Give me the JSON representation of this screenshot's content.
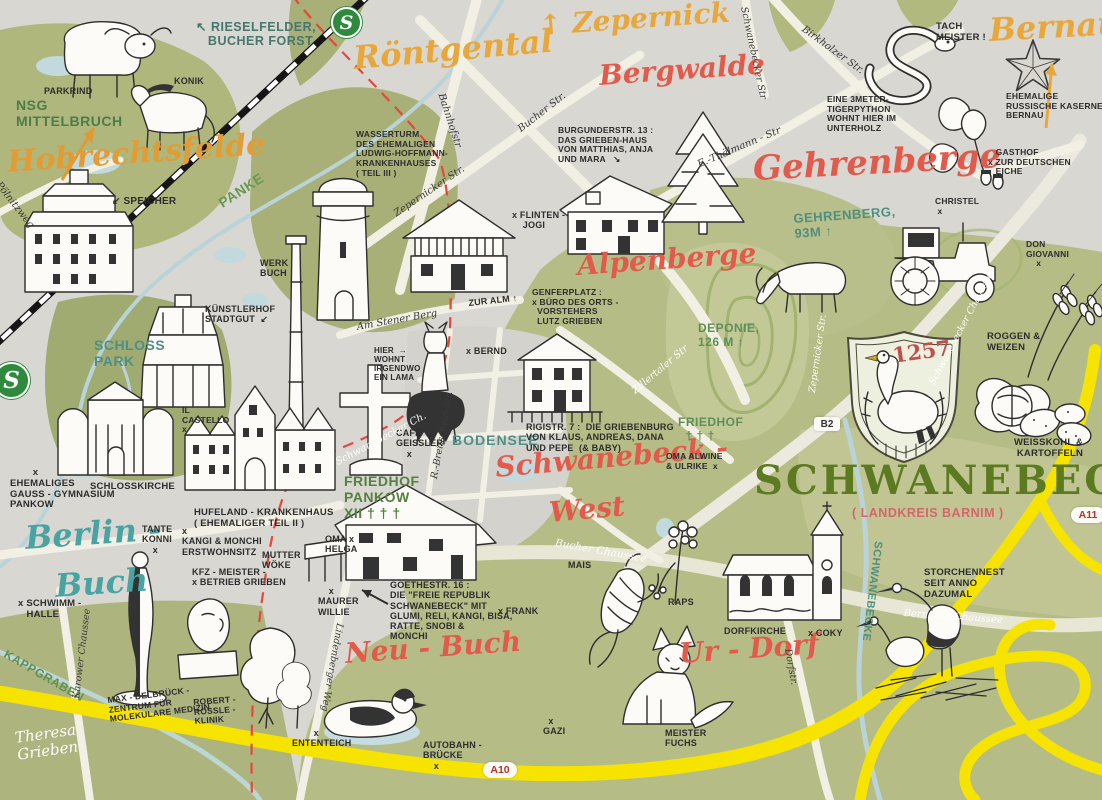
{
  "meta": {
    "map_subject": "Schwanebeck illustrated map"
  },
  "badges": {
    "sbahn_top": "S",
    "sbahn_left": "S",
    "b2": "B2",
    "a10": "A10",
    "a11": "A11"
  },
  "colors": {
    "paper": "#d8d7d2",
    "green_dark": "#9fab70",
    "green_mid": "#b5bc86",
    "green_light": "#c6ca9b",
    "road": "#f2efe4",
    "autobahn_yellow": "#f6e400",
    "water": "#b9d3d9",
    "railway": "#151515",
    "border_red": "#e2493c",
    "script_orange": "#e8a73a",
    "script_red": "#e25a4b",
    "script_teal": "#49a3a3",
    "label_green": "#55803f",
    "title_green": "#5c7a20",
    "crest_year_red": "#c0504d"
  },
  "illustrations": [
    "parkrind-cow",
    "konik-pony",
    "speicher-building",
    "water-tower",
    "chimney",
    "kuenstlerhof-rotunda",
    "schlosskirche-building",
    "hufeland-krankenhaus-building",
    "cemetery-cross",
    "alm-house",
    "grieben-haus",
    "fir-tree",
    "llama",
    "griebenburg-house",
    "goethestrasse-house",
    "woman-statue",
    "bust-statue",
    "birch-trees",
    "duck",
    "corn-cob",
    "raps-flower",
    "dorfkirche-church",
    "fox",
    "stork-nest",
    "tractor",
    "deer",
    "snake",
    "soviet-star",
    "oak-branch",
    "swan-crest",
    "wheat",
    "cabbage",
    "potatoes"
  ],
  "labels": [
    {
      "id": "place-hobrechtsfelde",
      "t": "Hobrechtsfelde",
      "x": 6,
      "y": 146,
      "s": 30,
      "c": "#e29c33",
      "f": "script",
      "r": -4
    },
    {
      "id": "place-roentgental",
      "t": "Röntgental",
      "x": 352,
      "y": 40,
      "s": 32,
      "c": "#e8a73a",
      "f": "script",
      "r": -5
    },
    {
      "id": "place-zepernick",
      "t": "↑ Zepernick",
      "x": 538,
      "y": 10,
      "s": 28,
      "c": "#e8a73a",
      "f": "script",
      "r": -4
    },
    {
      "id": "place-bergwalde",
      "t": "Bergwalde",
      "x": 598,
      "y": 60,
      "s": 28,
      "c": "#e25a4b",
      "f": "script",
      "r": -4
    },
    {
      "id": "place-bernau",
      "t": "Bernau",
      "x": 988,
      "y": 12,
      "s": 32,
      "c": "#e8a73a",
      "f": "script",
      "r": -3
    },
    {
      "id": "place-gehrenberge",
      "t": "Gehrenberge",
      "x": 752,
      "y": 150,
      "s": 34,
      "c": "#e25a4b",
      "f": "script",
      "r": -3
    },
    {
      "id": "place-alpenberge",
      "t": "Alpenberge",
      "x": 576,
      "y": 250,
      "s": 28,
      "c": "#e25a4b",
      "f": "script",
      "r": -4
    },
    {
      "id": "place-schwanebeck-west-1",
      "t": "Schwanebeck -",
      "x": 494,
      "y": 452,
      "s": 28,
      "c": "#e25a4b",
      "f": "script",
      "r": -5
    },
    {
      "id": "place-schwanebeck-west-2",
      "t": "West",
      "x": 548,
      "y": 497,
      "s": 28,
      "c": "#e25a4b",
      "f": "script",
      "r": -5
    },
    {
      "id": "place-berlin-buch-1",
      "t": "Berlin -",
      "x": 24,
      "y": 520,
      "s": 32,
      "c": "#49a3a3",
      "f": "script",
      "r": -4
    },
    {
      "id": "place-berlin-buch-2",
      "t": "Buch",
      "x": 54,
      "y": 568,
      "s": 32,
      "c": "#49a3a3",
      "f": "script",
      "r": -4
    },
    {
      "id": "place-neu-buch",
      "t": "Neu - Buch",
      "x": 344,
      "y": 638,
      "s": 28,
      "c": "#e25a4b",
      "f": "script",
      "r": -4
    },
    {
      "id": "place-ur-dorf",
      "t": "Ur - Dorf",
      "x": 678,
      "y": 638,
      "s": 28,
      "c": "#e25a4b",
      "f": "script",
      "r": -4
    },
    {
      "id": "map-title",
      "t": "SCHWANEBECK",
      "x": 754,
      "y": 458,
      "s": 40,
      "c": "#5c7a20",
      "f": "title",
      "r": 0,
      "ls": 3
    },
    {
      "id": "map-subtitle",
      "t": "( LANDKREIS BARNIM )",
      "x": 852,
      "y": 506,
      "s": 12.5,
      "c": "#d4666b",
      "f": "caps",
      "r": 0
    },
    {
      "id": "crest-year",
      "t": "1257",
      "x": 891,
      "y": 344,
      "s": 21,
      "c": "#c0504d",
      "f": "title",
      "r": -8
    },
    {
      "id": "area-nsg-mittelbruch",
      "t": "NSG\nMITTELBRUCH",
      "x": 16,
      "y": 98,
      "s": 14,
      "c": "#4e7c49",
      "f": "caps"
    },
    {
      "id": "area-rieselfelder",
      "t": "↖ RIESELFELDER,\n   BUCHER FORST",
      "x": 196,
      "y": 20,
      "s": 12.5,
      "c": "#47766f",
      "f": "caps"
    },
    {
      "id": "river-panke",
      "t": "PANKE",
      "x": 216,
      "y": 198,
      "s": 14,
      "c": "#69994e",
      "f": "caps",
      "r": -33
    },
    {
      "id": "area-schlosspark",
      "t": "SCHLOSS\nPARK",
      "x": 94,
      "y": 338,
      "s": 14,
      "c": "#4f8f87",
      "f": "caps"
    },
    {
      "id": "hill-gehrenberg",
      "t": "GEHRENBERG,\n93M ↑",
      "x": 793,
      "y": 212,
      "s": 13,
      "c": "#4f8f80",
      "f": "caps",
      "r": -4
    },
    {
      "id": "hill-deponie",
      "t": "DEPONIE,\n126 M ↑",
      "x": 698,
      "y": 322,
      "s": 12,
      "c": "#5d8f57",
      "f": "caps"
    },
    {
      "id": "area-friedhof-schwanebeck",
      "t": "FRIEDHOF\n  † † †",
      "x": 678,
      "y": 416,
      "s": 12,
      "c": "#5d8f57",
      "f": "caps"
    },
    {
      "id": "lake-bodensee",
      "t": "BODENSEE",
      "x": 452,
      "y": 433,
      "s": 14,
      "c": "#4f8f87",
      "f": "caps",
      "ls": 1
    },
    {
      "id": "area-friedhof-pankow",
      "t": "FRIEDHOF\nPANKOW\nXII † † †",
      "x": 344,
      "y": 474,
      "s": 14,
      "c": "#55803f",
      "f": "caps"
    },
    {
      "id": "stream-kappgraben",
      "t": "KAPPGRABEN",
      "x": 8,
      "y": 648,
      "s": 12,
      "c": "#5d8f57",
      "f": "caps",
      "r": 30
    },
    {
      "id": "stream-schwanebecke",
      "t": "SCHWANEBECKE",
      "x": 884,
      "y": 542,
      "s": 11,
      "c": "#4f8f80",
      "f": "caps",
      "r": 97
    },
    {
      "id": "note-parkrind",
      "t": "PARKRIND",
      "x": 44,
      "y": 86,
      "s": 9,
      "f": "hand"
    },
    {
      "id": "note-konik",
      "t": "KONIK",
      "x": 174,
      "y": 76,
      "s": 9,
      "f": "hand"
    },
    {
      "id": "note-speicher",
      "t": "↙ SPEICHER",
      "x": 112,
      "y": 196,
      "s": 10,
      "f": "hand"
    },
    {
      "id": "note-wasserturm",
      "t": "WASSERTURM\nDES EHEMALIGEN\nLUDWIG-HOFFMANN-\nKRANKENHAUSES\n( TEIL III )",
      "x": 356,
      "y": 130,
      "s": 8.5,
      "f": "hand"
    },
    {
      "id": "note-burgunderstr",
      "t": "BURGUNDERSTR. 13 :\nDAS GRIEBEN-HAUS\nVON MATTHIAS, ANJA\nUND MARA   ↘",
      "x": 558,
      "y": 126,
      "s": 8.5,
      "f": "hand"
    },
    {
      "id": "note-flinten-jogi",
      "t": "x FLINTEN -\n    JOGI",
      "x": 512,
      "y": 210,
      "s": 9,
      "f": "hand"
    },
    {
      "id": "note-tach-meister",
      "t": "TACH\nMEISTER !",
      "x": 936,
      "y": 22,
      "s": 9.5,
      "f": "hand"
    },
    {
      "id": "note-tigerpython",
      "t": "EINE 3METER-\nTIGERPYTHON\nWOHNT HIER IM\nUNTERHOLZ",
      "x": 827,
      "y": 95,
      "s": 8.5,
      "f": "hand"
    },
    {
      "id": "note-kaserne",
      "t": "EHEMALIGE\nRUSSISCHE KASERNE\nBERNAU",
      "x": 1006,
      "y": 92,
      "s": 8.5,
      "f": "hand"
    },
    {
      "id": "note-gasthof",
      "t": "   GASTHOF\nx ZUR DEUTSCHEN\n   EICHE",
      "x": 988,
      "y": 148,
      "s": 8.5,
      "f": "hand"
    },
    {
      "id": "note-christel",
      "t": "CHRISTEL\n x",
      "x": 935,
      "y": 197,
      "s": 8.5,
      "f": "hand"
    },
    {
      "id": "note-don-giovanni",
      "t": "DON\nGIOVANNI\n    x",
      "x": 1026,
      "y": 240,
      "s": 8.5,
      "f": "hand"
    },
    {
      "id": "note-roggen-weizen",
      "t": "ROGGEN &\nWEIZEN",
      "x": 987,
      "y": 332,
      "s": 9.5,
      "f": "hand"
    },
    {
      "id": "note-weisskohl",
      "t": "WEISSKOHL &\n KARTOFFELN",
      "x": 1014,
      "y": 438,
      "s": 9.5,
      "f": "hand"
    },
    {
      "id": "note-il-castello",
      "t": "IL\nCASTELLO\nx",
      "x": 182,
      "y": 406,
      "s": 8.5,
      "f": "hand"
    },
    {
      "id": "note-schlosskirche",
      "t": "SCHLOSSKIRCHE",
      "x": 90,
      "y": 482,
      "s": 9.5,
      "f": "hand"
    },
    {
      "id": "note-gauss-gymnasium",
      "t": "        x\nEHEMALIGES\nGAUSS - GYMNASIUM\nPANKOW",
      "x": 10,
      "y": 468,
      "s": 9.5,
      "f": "hand"
    },
    {
      "id": "note-hufeland",
      "t": "HUFELAND - KRANKENHAUS\n( EHEMALIGER TEIL II )",
      "x": 194,
      "y": 508,
      "s": 9.5,
      "f": "hand"
    },
    {
      "id": "note-tante-konni",
      "t": "TANTE\nKONNI\n    x",
      "x": 142,
      "y": 524,
      "s": 9,
      "f": "hand"
    },
    {
      "id": "note-kangi-monchi",
      "t": "x\nKANGI & MONCHI\nERSTWOHNSITZ",
      "x": 182,
      "y": 526,
      "s": 9,
      "f": "hand"
    },
    {
      "id": "note-kfz-grieben",
      "t": "KFZ - MEISTER -\nx BETRIEB GRIEBEN",
      "x": 192,
      "y": 567,
      "s": 9,
      "f": "hand"
    },
    {
      "id": "note-schwimmhalle",
      "t": "x SCHWIMM -\n   HALLE",
      "x": 18,
      "y": 599,
      "s": 9.5,
      "f": "hand"
    },
    {
      "id": "note-mdc",
      "t": "MAX - DELBRÜCK -\nZENTRUM FÜR\nMOLEKULARE MEDIZIN",
      "x": 107,
      "y": 696,
      "s": 8.5,
      "f": "hand",
      "r": -7
    },
    {
      "id": "note-roessle-klinik",
      "t": "ROBERT -\nRÖSSLE -\nKLINIK",
      "x": 193,
      "y": 698,
      "s": 8.5,
      "f": "hand",
      "r": -4
    },
    {
      "id": "note-ententeich",
      "t": "        x\nENTENTEICH",
      "x": 292,
      "y": 728,
      "s": 9,
      "f": "hand"
    },
    {
      "id": "note-autobahnbruecke",
      "t": "AUTOBAHN -\nBRÜCKE\n    x",
      "x": 423,
      "y": 740,
      "s": 9,
      "f": "hand"
    },
    {
      "id": "note-gazi",
      "t": "  x\nGAZI",
      "x": 543,
      "y": 716,
      "s": 9,
      "f": "hand"
    },
    {
      "id": "note-meister-fuchs",
      "t": "MEISTER\nFUCHS",
      "x": 665,
      "y": 728,
      "s": 9,
      "f": "hand"
    },
    {
      "id": "note-oma-helga",
      "t": "OMA x\nHELGA",
      "x": 325,
      "y": 534,
      "s": 9,
      "f": "hand"
    },
    {
      "id": "note-mutter-woeke",
      "t": "MUTTER\nWÖKE",
      "x": 262,
      "y": 550,
      "s": 9,
      "f": "hand"
    },
    {
      "id": "note-maurer-willie",
      "t": "    x\nMAURER\nWILLIE",
      "x": 318,
      "y": 586,
      "s": 9,
      "f": "hand"
    },
    {
      "id": "note-frank",
      "t": "x FRANK",
      "x": 498,
      "y": 606,
      "s": 9,
      "f": "hand"
    },
    {
      "id": "note-goethestrasse",
      "t": "GOETHESTR. 16 :\nDIE \"FREIE REPUBLIK\nSCHWANEBECK\" MIT\nGLUMI, RELI, KANGI, BISA,\nRATTE, SNOBI &\nMONCHI",
      "x": 390,
      "y": 580,
      "s": 9,
      "f": "hand"
    },
    {
      "id": "note-cafe-geissler",
      "t": "CAFÉ\nGEISSLER\n    x",
      "x": 396,
      "y": 428,
      "s": 9,
      "f": "hand"
    },
    {
      "id": "note-lama",
      "t": "HIER  →\nWOHNT\nIRGENDWO\nEIN LAMA",
      "x": 374,
      "y": 346,
      "s": 8,
      "f": "hand"
    },
    {
      "id": "note-bernd",
      "t": "x BERND",
      "x": 466,
      "y": 346,
      "s": 9,
      "f": "hand"
    },
    {
      "id": "note-rigistr",
      "t": "RIGISTR. 7 :  DIE GRIEBENBURG\nVON KLAUS, ANDREAS, DANA\nUND PEPE  (& BABY)",
      "x": 526,
      "y": 422,
      "s": 9,
      "f": "hand"
    },
    {
      "id": "note-genferplatz",
      "t": "GENFERPLATZ :\nx BÜRO DES ORTS -\n  VORSTEHERS\n  LUTZ GRIEBEN",
      "x": 532,
      "y": 288,
      "s": 8.5,
      "f": "hand"
    },
    {
      "id": "note-zur-alm",
      "t": "ZUR ALM ↑",
      "x": 468,
      "y": 298,
      "s": 9,
      "f": "hand",
      "r": -6
    },
    {
      "id": "note-oma-alwine",
      "t": "OMA ALWINE\n& ULRIKE  x",
      "x": 666,
      "y": 452,
      "s": 8.5,
      "f": "hand"
    },
    {
      "id": "note-dorfkirche",
      "t": "DORFKIRCHE",
      "x": 724,
      "y": 626,
      "s": 9,
      "f": "hand"
    },
    {
      "id": "note-coky",
      "t": "x COKY",
      "x": 808,
      "y": 628,
      "s": 9,
      "f": "hand"
    },
    {
      "id": "note-storchennest",
      "t": "STORCHENNEST\nSEIT ANNO\nDAZUMAL",
      "x": 924,
      "y": 568,
      "s": 9.5,
      "f": "hand"
    },
    {
      "id": "note-mais",
      "t": "MAIS",
      "x": 568,
      "y": 560,
      "s": 9,
      "f": "hand"
    },
    {
      "id": "note-raps",
      "t": "RAPS",
      "x": 668,
      "y": 597,
      "s": 9,
      "f": "hand"
    },
    {
      "id": "note-werk-buch",
      "t": "WERK\nBUCH",
      "x": 260,
      "y": 258,
      "s": 9,
      "f": "hand"
    },
    {
      "id": "note-kuenstlerhof",
      "t": "KÜNSTLERHOF\nSTADTGUT  ↙",
      "x": 205,
      "y": 304,
      "s": 9,
      "f": "hand"
    },
    {
      "id": "street-bahnhofstr",
      "t": "Bahnhofstr",
      "x": 446,
      "y": 92,
      "s": 10,
      "f": "street",
      "r": 72
    },
    {
      "id": "street-bucher-str",
      "t": "Bucher Str.",
      "x": 516,
      "y": 126,
      "s": 10,
      "f": "street",
      "r": -38
    },
    {
      "id": "street-zepernicker-str",
      "t": "Zepernicker Str.",
      "x": 392,
      "y": 210,
      "s": 10,
      "f": "street",
      "r": -34
    },
    {
      "id": "street-am-stener-berg",
      "t": "Am Stener Berg",
      "x": 356,
      "y": 322,
      "s": 10,
      "f": "street",
      "r": -10
    },
    {
      "id": "street-birkholzer-str",
      "t": "Birkholzer Str.",
      "x": 806,
      "y": 24,
      "s": 10,
      "f": "street",
      "r": 36
    },
    {
      "id": "street-schwanebecker-str",
      "t": "Schwanebecker Str",
      "x": 748,
      "y": 6,
      "s": 9.5,
      "f": "street",
      "r": 78
    },
    {
      "id": "street-thaelmann-str",
      "t": "E.-Thälmann - Str",
      "x": 696,
      "y": 160,
      "s": 10,
      "f": "street",
      "r": -23
    },
    {
      "id": "street-breitscheid-str",
      "t": "R.-Breitscheid-Str.",
      "x": 430,
      "y": 478,
      "s": 9.5,
      "f": "street",
      "r": -80
    },
    {
      "id": "street-poelnitzweg",
      "t": "Pölnitzweg",
      "x": 2,
      "y": 180,
      "s": 10,
      "f": "street",
      "r": 52
    },
    {
      "id": "street-karower-chaussee",
      "t": "Karower Chaussee",
      "x": 72,
      "y": 698,
      "s": 9.5,
      "f": "street",
      "r": -83
    },
    {
      "id": "street-lindenberger-weg",
      "t": "Lindenberger Weg",
      "x": 344,
      "y": 624,
      "s": 9.5,
      "f": "street",
      "r": 100
    },
    {
      "id": "street-dorfstr",
      "t": "Dorfstr.",
      "x": 792,
      "y": 648,
      "s": 9.5,
      "f": "street",
      "r": 80
    },
    {
      "id": "street-schwanebecker-ch",
      "t": "Schwanebecker Ch.",
      "x": 334,
      "y": 458,
      "s": 10,
      "f": "streetw",
      "r": -28
    },
    {
      "id": "street-zillertaler-str",
      "t": "Zillertaler Str",
      "x": 630,
      "y": 388,
      "s": 10,
      "f": "streetw",
      "r": -40
    },
    {
      "id": "street-zepernicker-str-w",
      "t": "Zepernicker Str.",
      "x": 808,
      "y": 392,
      "s": 9.5,
      "f": "streetw",
      "r": -82
    },
    {
      "id": "street-bucher-chaussee",
      "t": "Bucher Chaussee",
      "x": 556,
      "y": 538,
      "s": 10.5,
      "f": "streetw",
      "r": 10
    },
    {
      "id": "street-bernauer-chaussee",
      "t": "Bernauer Chaussee",
      "x": 904,
      "y": 608,
      "s": 10,
      "f": "streetw",
      "r": 4
    },
    {
      "id": "street-schwanebecker-chaussee",
      "t": "Schwanebecker Chaussee",
      "x": 928,
      "y": 382,
      "s": 9.5,
      "f": "streetw",
      "r": -62
    },
    {
      "id": "artist-signature",
      "t": "Theresa\nGrieben",
      "x": 14,
      "y": 730,
      "s": 15,
      "f": "sig",
      "r": -8
    }
  ]
}
